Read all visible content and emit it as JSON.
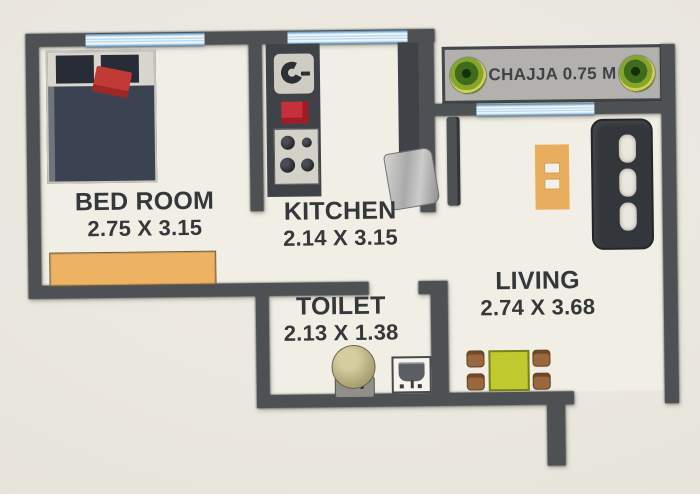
{
  "rooms": {
    "bedroom": {
      "label": "BED ROOM",
      "dims": "2.75 X 3.15"
    },
    "kitchen": {
      "label": "KITCHEN",
      "dims": "2.14 X 3.15"
    },
    "toilet": {
      "label": "TOILET",
      "dims": "2.13 X 1.38"
    },
    "living": {
      "label": "LIVING",
      "dims": "2.74 X 3.68"
    },
    "chajja": {
      "label": "CHAJJA 0.75 M"
    }
  },
  "furniture_icons": [
    "double-bed-icon",
    "wardrobe-icon",
    "kitchen-sink-icon",
    "gas-stove-icon",
    "cooktop-burners-icon",
    "refrigerator-icon",
    "door-leaf-icon",
    "sofa-icon",
    "tv-unit-icon",
    "dining-table-icon",
    "dining-chair-icon",
    "toilet-wc-icon",
    "washbasin-icon",
    "plant-icon"
  ],
  "colors": {
    "wall": "#4e5154",
    "floor": "#f1eee5",
    "window": "#a9d0ea",
    "chajja": "#b2b1ad",
    "text": "#35383b",
    "bed": "#3b4252",
    "cushion": "#c23a35",
    "wardrobe": "#eeb263",
    "counter": "#3f4347",
    "gas": "#c5303a",
    "unit": "#e9ae5d",
    "table": "#c0ca2f",
    "chair": "#99683c"
  }
}
